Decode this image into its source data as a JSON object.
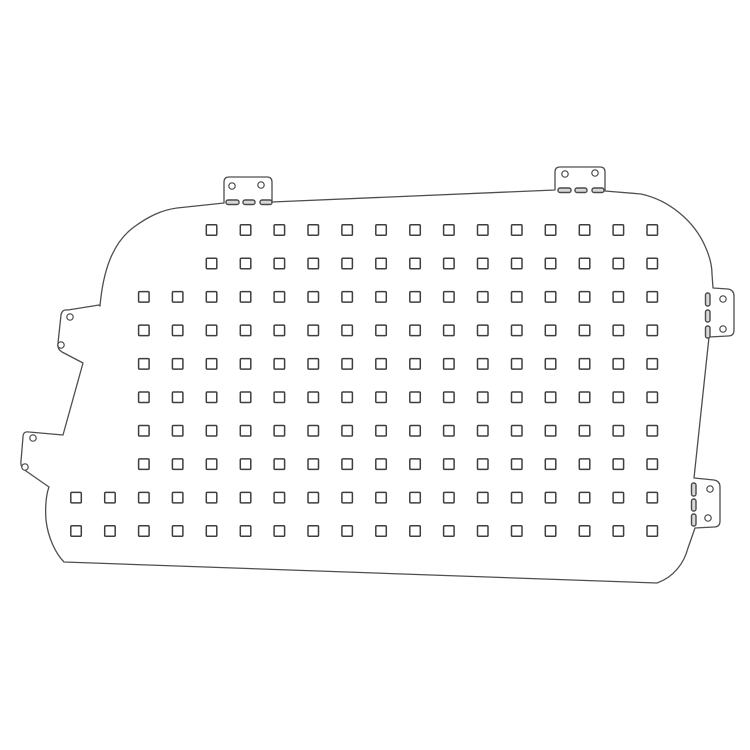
{
  "page": {
    "background_color": "#ffffff",
    "content_type": "technical line drawing of a perforated van-window blank panel with mounting tabs"
  },
  "drawing": {
    "canvas": {
      "width": 750,
      "height": 750
    },
    "colors": {
      "panel_fill": "#ffffff",
      "outline_stroke": "#4f4f4f",
      "square_stroke": "#3e3e3e",
      "hole_stroke": "#4a4a4a",
      "slot_stroke": "#4a4a4a",
      "slot_fill": "#d9d9d9"
    },
    "stroke": {
      "outline_width": 1.3,
      "square_width": 1.5,
      "hole_width": 1.2,
      "slot_width": 1.4
    },
    "outline_path": "M 100,306 C 103,272 112,243 134,227 C 149,216 162,210 177,208 L 224,203 L 224,182 Q 224,177 229,177 L 267,177 Q 272,177 272,182 L 272,202 L 555,190 L 555,172 Q 555,167 560,167 L 600,167 Q 605,167 605,172 L 605,191 L 641,194 C 669,200 694,221 705,246 C 710,257 712,265 712,274 L 713,288 L 728,289 Q 734,290 734,296 L 734,330 Q 734,336 728,336 L 709,337 L 694,478 L 714,480 Q 720,481 720,487 L 720,521 Q 720,527 714,527 L 695,528 L 688,548 C 684,563 674,577 657,583 L 64,562 C 56,554 48,538 46,520 C 45,508 46,495 49,487 L 26,471 Q 20,467 21,461 L 23,437 Q 23,431 29,432 L 63,435 L 83,363 L 62,352 Q 57,349 58,343 L 61,315 Q 62,309 68,310 L 99,305 Z",
    "tabs": [
      {
        "name": "top-left-tab",
        "holes": 2,
        "slots": 3
      },
      {
        "name": "top-right-tab",
        "holes": 2,
        "slots": 3
      },
      {
        "name": "right-upper-tab",
        "holes": 2,
        "slots": 3
      },
      {
        "name": "right-lower-tab",
        "holes": 2,
        "slots": 3
      },
      {
        "name": "left-upper-tab",
        "holes": 2,
        "slots": 0
      },
      {
        "name": "left-lower-tab",
        "holes": 2,
        "slots": 0
      }
    ],
    "perforation_grid": {
      "square_size": 10.5,
      "square_corner_radius": 1,
      "col_origin_x": 76,
      "col_spacing": 33.9,
      "row_origin_y": 230,
      "row_spacing": 33.45,
      "total_squares": 160,
      "rows": [
        {
          "start_col": 4,
          "count": 14
        },
        {
          "start_col": 4,
          "count": 14
        },
        {
          "start_col": 2,
          "count": 16
        },
        {
          "start_col": 2,
          "count": 16
        },
        {
          "start_col": 2,
          "count": 16
        },
        {
          "start_col": 2,
          "count": 16
        },
        {
          "start_col": 2,
          "count": 16
        },
        {
          "start_col": 2,
          "count": 16
        },
        {
          "start_col": 0,
          "count": 18
        },
        {
          "start_col": 0,
          "count": 18
        }
      ]
    },
    "mounting_holes": [
      {
        "cx": 232,
        "cy": 186,
        "r": 3.2,
        "tab": "top-left-tab"
      },
      {
        "cx": 261,
        "cy": 185,
        "r": 3.2,
        "tab": "top-left-tab"
      },
      {
        "cx": 565,
        "cy": 174,
        "r": 3.2,
        "tab": "top-right-tab"
      },
      {
        "cx": 595,
        "cy": 173,
        "r": 3.2,
        "tab": "top-right-tab"
      },
      {
        "cx": 723,
        "cy": 299,
        "r": 3.2,
        "tab": "right-upper-tab"
      },
      {
        "cx": 723,
        "cy": 329,
        "r": 3.2,
        "tab": "right-upper-tab"
      },
      {
        "cx": 710,
        "cy": 489,
        "r": 3.2,
        "tab": "right-lower-tab"
      },
      {
        "cx": 708,
        "cy": 518,
        "r": 3.2,
        "tab": "right-lower-tab"
      },
      {
        "cx": 70,
        "cy": 317,
        "r": 3.2,
        "tab": "left-upper-tab"
      },
      {
        "cx": 61,
        "cy": 345,
        "r": 3.2,
        "tab": "left-upper-tab"
      },
      {
        "cx": 33,
        "cy": 438,
        "r": 3.2,
        "tab": "left-lower-tab"
      },
      {
        "cx": 25,
        "cy": 467,
        "r": 3.2,
        "tab": "left-lower-tab"
      }
    ],
    "slots": [
      {
        "x": 226,
        "y": 200,
        "w": 13,
        "h": 4.5,
        "tab": "top-left-tab"
      },
      {
        "x": 243,
        "y": 200,
        "w": 12,
        "h": 4.5,
        "tab": "top-left-tab"
      },
      {
        "x": 260,
        "y": 200,
        "w": 12,
        "h": 4.5,
        "tab": "top-left-tab"
      },
      {
        "x": 558,
        "y": 188,
        "w": 13,
        "h": 4.5,
        "tab": "top-right-tab"
      },
      {
        "x": 575,
        "y": 188,
        "w": 12,
        "h": 4.5,
        "tab": "top-right-tab"
      },
      {
        "x": 592,
        "y": 188,
        "w": 12,
        "h": 4.5,
        "tab": "top-right-tab"
      },
      {
        "x": 705.5,
        "y": 293,
        "w": 4.5,
        "h": 13,
        "tab": "right-upper-tab"
      },
      {
        "x": 705.5,
        "y": 310,
        "w": 4.5,
        "h": 12,
        "tab": "right-upper-tab"
      },
      {
        "x": 705.5,
        "y": 326,
        "w": 4.5,
        "h": 12,
        "tab": "right-upper-tab"
      },
      {
        "x": 691.5,
        "y": 483,
        "w": 4.5,
        "h": 13,
        "tab": "right-lower-tab"
      },
      {
        "x": 691.5,
        "y": 499,
        "w": 4.5,
        "h": 12,
        "tab": "right-lower-tab"
      },
      {
        "x": 691.5,
        "y": 514,
        "w": 4.5,
        "h": 12,
        "tab": "right-lower-tab"
      }
    ]
  }
}
